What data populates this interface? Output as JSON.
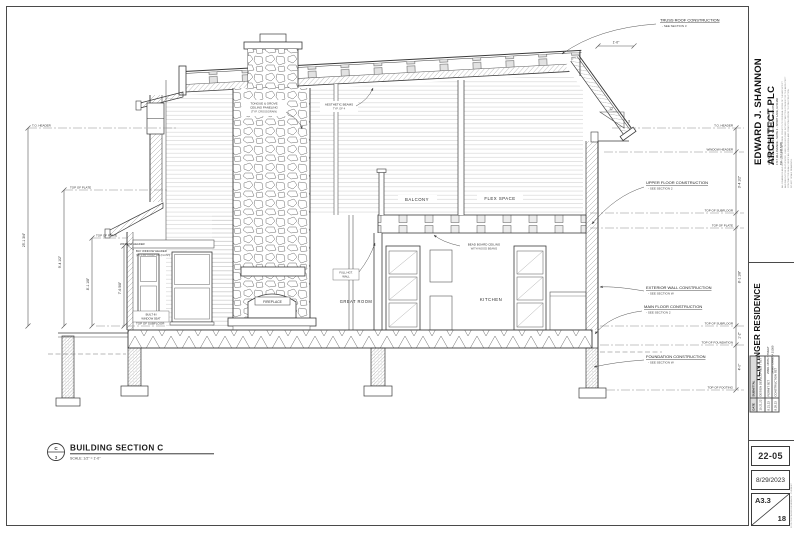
{
  "colors": {
    "line_dark": "#3a3a3a",
    "line_mid": "#777777",
    "line_light": "#c9c9c9",
    "dash": "#8a8a8a",
    "text": "#2b2b2b"
  },
  "title_bar": {
    "symbol_top": "C",
    "symbol_bottom": "3",
    "title": "BUILDING SECTION C",
    "scale": "SCALE: 1/2\" = 1'-0\""
  },
  "rooms": {
    "balcony": "BALCONY",
    "flex_space": "FLEX SPACE",
    "great_room": "GREAT ROOM",
    "kitchen": "KITCHEN",
    "fireplace": "FIREPLACE"
  },
  "callouts": {
    "truss_roof": {
      "line1": "TRUSS ROOF CONSTRUCTION",
      "line2": "- SEE SECTION 3"
    },
    "upper_floor": {
      "line1": "UPPER FLOOR CONSTRUCTION",
      "line2": "- SEE SECTION 2"
    },
    "exterior_wall": {
      "line1": "EXTERIOR WALL CONSTRUCTION",
      "line2": "- SEE SECTION W"
    },
    "main_floor": {
      "line1": "MAIN FLOOR CONSTRUCTION",
      "line2": "- SEE SECTION 2"
    },
    "foundation": {
      "line1": "FOUNDATION CONSTRUCTION",
      "line2": "- SEE SECTION W"
    },
    "tg_ceiling": {
      "line1": "TONGUE & GROVE",
      "line2": "CEILING PANELING",
      "line3": "(TYP. CROSSGRAIN)"
    },
    "beams": {
      "line1": "AESTHETIC BEAMS",
      "line2": "TYP. OF 4"
    },
    "bead_board": {
      "line1": "BEAD BOARD CEILING",
      "line2": "WITH WOOD BEAMS"
    },
    "full_height": {
      "line1": "FULL HGT.",
      "line2": "WALL"
    },
    "window_seat": {
      "line1": "BUILT-IN",
      "line2": "WINDOW SEAT"
    },
    "bay_header": {
      "line1": "WINDOW HEADER",
      "line2": "BAY WINDOW HEADER",
      "line3": "(W) 1 3/4\" x 9 1/2\" LVL (FLUSH)"
    }
  },
  "levels": {
    "left": [
      "T.O. HEADER",
      "TOP OF PLATE",
      "TOP OF PLATE",
      "TOP OF SUBFLOOR"
    ],
    "right": [
      "T.O. HEADER",
      "WINDOW HEADER",
      "TOP OF SUBFLOOR",
      "TOP OF PLATE",
      "TOP OF SUBFLOOR",
      "TOP OF FOUNDATION",
      "TOP OF FOOTING"
    ]
  },
  "dims": {
    "overall": "25'-1 3/4\"",
    "left_a": "9'-4 1/2\"",
    "left_b": "8'-1 1/8\"",
    "left_c": "7'-6 5/8\"",
    "right_a": "3'-4 1/2\"",
    "right_b": "8'-1 1/8\"",
    "right_c": "1'-2\"",
    "right_d": "4'-0\"",
    "overhang": "1'-0\"",
    "slope_run": "12",
    "slope_rise": "3"
  },
  "title_block": {
    "architect": {
      "name": "EDWARD J. SHANNON ARCHITECT PLC",
      "credentials": [
        "LICENSED ARCHITECT - STATE OF IOWA",
        "LICENSED ARCHITECT - STATE OF MINNESOTA"
      ],
      "contact": [
        "1717 HILL AVENUE - SUITE 2 - SPIRIT LAKE, IA 51360",
        "TEL: 712.336.5405"
      ],
      "fine_print": [
        "ALL DRAWINGS AND WRITTEN MATERIAL HEREIN CONSTITUTE ORIGINAL WORK OF THE ARCHITECT",
        "AND MAY NOT BE DUPLICATED, USED OR DISCLOSED WITHOUT WRITTEN CONSENT OF THE ARCHITECT.",
        "CONTRACTOR SHALL VERIFY ALL DIMENSIONS AND CONDITIONS PRIOR TO CONSTRUCTION.",
        "DO NOT SCALE DRAWINGS."
      ]
    },
    "project": {
      "name": "TENTINGER RESIDENCE",
      "address_line1": "25601 155TH STREET",
      "address_line2": "SPIRIT LAKE, IA 51360"
    },
    "submittals": {
      "headers": [
        "DATE",
        "SUBMITTAL"
      ],
      "rows": [
        [
          "10.21.22",
          "DESIGN DEVELOPMENT SET"
        ],
        [
          "8.21.23",
          "PERMIT SET"
        ],
        [
          "8.29.23",
          "CONSTRUCTION SET"
        ]
      ]
    },
    "project_number": "22-05",
    "date": "8/29/2023",
    "sheet_number": "A3.3",
    "sheet_count": "18",
    "file_path": "22-05 TENTINGER RESIDENCE - CURRENT"
  }
}
